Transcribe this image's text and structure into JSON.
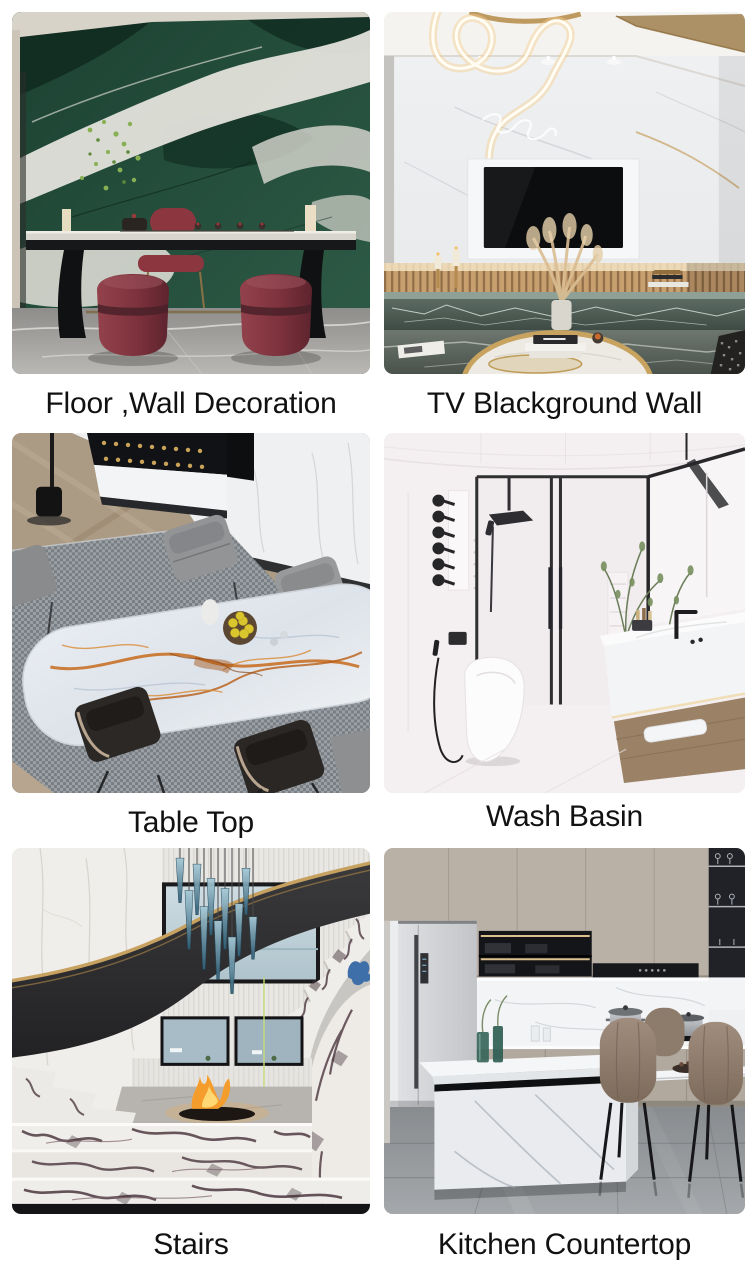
{
  "page": {
    "background": "#ffffff",
    "caption_color": "#111111"
  },
  "gallery": {
    "items": [
      {
        "caption": "Floor ,Wall Decoration",
        "image": "green-marble-tea-room-photo"
      },
      {
        "caption": "TV Blackground Wall",
        "image": "white-marble-tv-wall-living-room-photo"
      },
      {
        "caption": "Table Top",
        "image": "orange-vein-marble-dining-table-photo"
      },
      {
        "caption": "Wash Basin",
        "image": "bathroom-shower-and-wash-basin-photo"
      },
      {
        "caption": "Stairs",
        "image": "curved-marble-staircase-photo"
      },
      {
        "caption": "Kitchen Countertop",
        "image": "marble-kitchen-island-countertop-photo"
      }
    ]
  }
}
